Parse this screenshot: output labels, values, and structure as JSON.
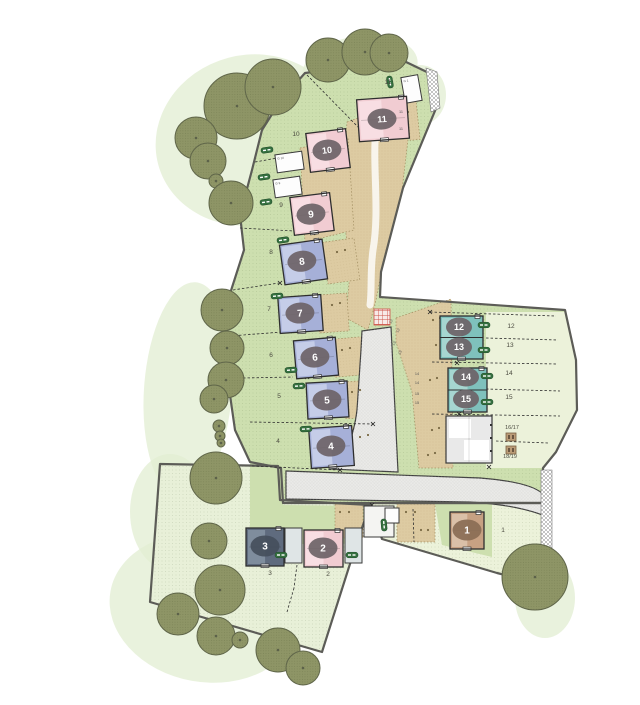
{
  "title": "Housing development site plan",
  "colors": {
    "background": "#ffffff",
    "field_green": "#cddfaf",
    "field_pale": "#e8f0d8",
    "garden_pale": "#ecf2da",
    "blob_green": "#e2edd2",
    "tree_fill": "#8e9566",
    "tree_edge": "#60664a",
    "tan_drive": "#ddcba2",
    "road_fill": "#eaeae8",
    "road_edge": "#3d3d3d",
    "boundary": "#5c5c57",
    "house_outline": "#2e2e2e",
    "badge_fill": "#6d6367",
    "badge_text": "#ffffff",
    "label_text": "#4b4b40",
    "pink": "#f1ccd2",
    "pink_light": "#f8e0e4",
    "lavender": "#a6b0d8",
    "lavender_light": "#c9d0ea",
    "teal": "#7fc1bc",
    "teal_light": "#abd8d3",
    "slate": "#5f6b7e",
    "slate_light": "#8391a1",
    "brown": "#c7a183",
    "brown_light": "#dbc3ac",
    "badge_brown": "#8a6d55",
    "badge_dark": "#454f5c",
    "garage_fill": "#fdfdfd",
    "block_fill": "#e9e9e9",
    "pill_green": "#35703f",
    "red_hatch": "#cc5146",
    "bin_fill": "#bb9c77"
  },
  "plan": {
    "fields": {
      "north": "305,73 404,61 431,74 437,106 403,188 381,272 380,297 565,310 576,360 577,410 556,452 543,468 543,503 283,503 281,468 250,462 235,430 230,395 226,350 228,300 244,250 240,215 252,170 262,130 281,100",
      "southwest": "160,464 278,466 280,500 370,505 356,545 322,652 150,602",
      "southeast": "370,503 543,503 546,550 537,583 497,573 382,539"
    },
    "overlays": [
      {
        "pts": "486,312 565,312 576,360 577,408 556,452 543,468 486,468",
        "fill": "garden_pale"
      },
      {
        "pts": "250,463 281,468 283,505 368,506 357,543 250,545",
        "fill": "field_green"
      },
      {
        "pts": "435,504 492,504 492,557 442,545",
        "fill": "field_green"
      }
    ],
    "blobs": [
      [
        250,
        140,
        95,
        85,
        -15
      ],
      [
        360,
        68,
        58,
        32,
        -8
      ],
      [
        420,
        95,
        26,
        30,
        0
      ],
      [
        188,
        390,
        44,
        108,
        4
      ],
      [
        170,
        512,
        40,
        58,
        0
      ],
      [
        205,
        608,
        96,
        74,
        10
      ],
      [
        545,
        598,
        30,
        40,
        0
      ]
    ],
    "tans": [
      "347,122 413,98 402,190 384,258 376,300 368,330 346,318 350,272 345,225 344,170",
      "300,148 348,138 354,230 305,242",
      "396,318 451,299 453,468 419,468 412,392 396,342"
    ],
    "bays": [
      [
        325,
        240,
        32,
        42,
        -8
      ],
      [
        318,
        294,
        30,
        38,
        -4
      ],
      [
        333,
        338,
        30,
        38,
        -5
      ],
      [
        345,
        381,
        28,
        37,
        -3
      ],
      [
        352,
        426,
        28,
        41,
        -3
      ],
      [
        335,
        504,
        28,
        34,
        0
      ],
      [
        397,
        504,
        38,
        38,
        0
      ],
      [
        408,
        100,
        10,
        40,
        -6
      ]
    ],
    "roads": {
      "main": "M286,471 L480,478 Q543,483 546,500 L545,516 Q518,505 470,502 L286,499 Z",
      "spur": "M362,331 L391,327 L398,472 L330,469 Q352,452 357,410 L361,350 Z"
    },
    "white_path": "M376,128 C372,165 380,210 373,250 C370,272 372,290 370,305",
    "hatches": [
      "541,470 552,470 552,552 541,552",
      "426,68 437,72 440,108 431,112"
    ],
    "red_hatch": {
      "x": 374,
      "y": 309,
      "s": 16
    },
    "houses": [
      {
        "n": "1",
        "c": "brown",
        "x": 450,
        "y": 512,
        "w": 34,
        "h": 37,
        "rot": 0,
        "bx": 467,
        "by": 530,
        "badge": "badge_brown"
      },
      {
        "n": "2",
        "c": "pink",
        "x": 304,
        "y": 530,
        "w": 39,
        "h": 37,
        "rot": 0,
        "bx": 323,
        "by": 548
      },
      {
        "n": "3",
        "c": "slate",
        "x": 246,
        "y": 528,
        "w": 38,
        "h": 38,
        "rot": 0,
        "bx": 265,
        "by": 546,
        "badge": "badge_dark"
      },
      {
        "n": "4",
        "c": "lavender",
        "x": 310,
        "y": 427,
        "w": 43,
        "h": 40,
        "rot": -4,
        "bx": 331,
        "by": 446
      },
      {
        "n": "5",
        "c": "lavender",
        "x": 307,
        "y": 382,
        "w": 41,
        "h": 36,
        "rot": -3,
        "bx": 327,
        "by": 400
      },
      {
        "n": "6",
        "c": "lavender",
        "x": 295,
        "y": 339,
        "w": 42,
        "h": 38,
        "rot": -5,
        "bx": 315,
        "by": 357
      },
      {
        "n": "7",
        "c": "lavender",
        "x": 279,
        "y": 296,
        "w": 43,
        "h": 36,
        "rot": -4,
        "bx": 300,
        "by": 313
      },
      {
        "n": "8",
        "c": "lavender",
        "x": 282,
        "y": 242,
        "w": 43,
        "h": 40,
        "rot": -8,
        "bx": 302,
        "by": 261
      },
      {
        "n": "9",
        "c": "pink",
        "x": 292,
        "y": 195,
        "w": 40,
        "h": 38,
        "rot": -7,
        "bx": 311,
        "by": 214
      },
      {
        "n": "10",
        "c": "pink",
        "x": 308,
        "y": 131,
        "w": 40,
        "h": 39,
        "rot": -7,
        "bx": 327,
        "by": 150
      },
      {
        "n": "11",
        "c": "pink",
        "x": 358,
        "y": 98,
        "w": 50,
        "h": 42,
        "rot": -4,
        "bx": 382,
        "by": 119
      },
      {
        "pair": [
          "12",
          "13"
        ],
        "c": "teal",
        "x": 440,
        "y": 316,
        "w": 43,
        "h": 43,
        "rot": 0,
        "badges": [
          [
            459,
            327
          ],
          [
            459,
            347
          ]
        ]
      },
      {
        "pair": [
          "14",
          "15"
        ],
        "c": "teal",
        "x": 448,
        "y": 368,
        "w": 39,
        "h": 44,
        "rot": 0,
        "badges": [
          [
            466,
            377
          ],
          [
            466,
            399
          ]
        ]
      }
    ],
    "block": {
      "x": 446,
      "y": 416,
      "w": 46,
      "h": 47
    },
    "aux_buildings": [
      {
        "x": 285,
        "y": 528,
        "w": 17,
        "h": 35,
        "fill": "#dfe5e6"
      },
      {
        "x": 345,
        "y": 528,
        "w": 17,
        "h": 35,
        "fill": "#dfe5e6"
      },
      {
        "x": 364,
        "y": 506,
        "w": 30,
        "h": 31,
        "fill": "#f4f4f2"
      },
      {
        "x": 385,
        "y": 508,
        "w": 14,
        "h": 15,
        "fill": "#fdfdfd"
      }
    ],
    "garages": [
      {
        "x": 403,
        "y": 76,
        "w": 17,
        "h": 26,
        "rot": -10,
        "label": "G 1"
      },
      {
        "x": 276,
        "y": 153,
        "w": 27,
        "h": 18,
        "rot": -8,
        "label": "G 10"
      },
      {
        "x": 274,
        "y": 178,
        "w": 27,
        "h": 18,
        "rot": -8,
        "label": "G 9"
      }
    ],
    "bins": [
      [
        506,
        433,
        10,
        8
      ],
      [
        506,
        446,
        10,
        8
      ]
    ],
    "pills": [
      [
        390,
        82,
        80
      ],
      [
        267,
        150,
        -8
      ],
      [
        264,
        177,
        -8
      ],
      [
        266,
        202,
        -8
      ],
      [
        283,
        240,
        -8
      ],
      [
        277,
        296,
        -4
      ],
      [
        291,
        370,
        -4
      ],
      [
        299,
        386,
        -3
      ],
      [
        306,
        429,
        -3
      ],
      [
        484,
        325,
        0
      ],
      [
        484,
        350,
        0
      ],
      [
        487,
        376,
        0
      ],
      [
        487,
        402,
        0
      ],
      [
        281,
        555,
        0
      ],
      [
        352,
        555,
        0
      ],
      [
        384,
        525,
        85
      ]
    ],
    "trees": [
      [
        237,
        106,
        33
      ],
      [
        273,
        87,
        28
      ],
      [
        328,
        60,
        22
      ],
      [
        365,
        52,
        23
      ],
      [
        389,
        53,
        19
      ],
      [
        196,
        138,
        21
      ],
      [
        208,
        161,
        18
      ],
      [
        216,
        181,
        7
      ],
      [
        231,
        203,
        22
      ],
      [
        222,
        310,
        21
      ],
      [
        227,
        348,
        17
      ],
      [
        226,
        380,
        18
      ],
      [
        214,
        399,
        14
      ],
      [
        219,
        426,
        6
      ],
      [
        220,
        436,
        5
      ],
      [
        221,
        443,
        4
      ],
      [
        216,
        478,
        26
      ],
      [
        209,
        541,
        18
      ],
      [
        220,
        590,
        25
      ],
      [
        178,
        614,
        21
      ],
      [
        216,
        636,
        19
      ],
      [
        240,
        640,
        8
      ],
      [
        278,
        650,
        22
      ],
      [
        303,
        668,
        17
      ],
      [
        535,
        577,
        33
      ]
    ],
    "plot_labels": [
      {
        "t": "11",
        "x": 388,
        "y": 84
      },
      {
        "t": "10",
        "x": 296,
        "y": 136
      },
      {
        "t": "9",
        "x": 281,
        "y": 207
      },
      {
        "t": "8",
        "x": 271,
        "y": 254
      },
      {
        "t": "7",
        "x": 269,
        "y": 311
      },
      {
        "t": "6",
        "x": 271,
        "y": 357
      },
      {
        "t": "5",
        "x": 279,
        "y": 398
      },
      {
        "t": "4",
        "x": 278,
        "y": 443
      },
      {
        "t": "3",
        "x": 270,
        "y": 575
      },
      {
        "t": "2",
        "x": 328,
        "y": 576
      },
      {
        "t": "1",
        "x": 503,
        "y": 532
      },
      {
        "t": "12",
        "x": 511,
        "y": 328
      },
      {
        "t": "13",
        "x": 510,
        "y": 347
      },
      {
        "t": "14",
        "x": 509,
        "y": 375
      },
      {
        "t": "15",
        "x": 509,
        "y": 399
      },
      {
        "t": "16/17",
        "x": 512,
        "y": 429
      },
      {
        "t": "18/19",
        "x": 510,
        "y": 458
      }
    ],
    "bay_labels": [
      {
        "t": "11",
        "x": 401,
        "y": 113,
        "r": 0
      },
      {
        "t": "11",
        "x": 401,
        "y": 130,
        "r": 0
      },
      {
        "t": "12",
        "x": 392,
        "y": 322,
        "r": -60
      },
      {
        "t": "12",
        "x": 399,
        "y": 331,
        "r": -60
      },
      {
        "t": "13",
        "x": 395,
        "y": 344,
        "r": -60
      },
      {
        "t": "13",
        "x": 401,
        "y": 353,
        "r": -60
      },
      {
        "t": "14",
        "x": 417,
        "y": 375,
        "r": 0
      },
      {
        "t": "14",
        "x": 417,
        "y": 384,
        "r": 0
      },
      {
        "t": "15",
        "x": 417,
        "y": 395,
        "r": 0
      },
      {
        "t": "15",
        "x": 417,
        "y": 404,
        "r": 0
      }
    ],
    "dashed": [
      [
        307,
        75,
        360,
        129
      ],
      [
        255,
        162,
        300,
        154
      ],
      [
        240,
        228,
        313,
        232
      ],
      [
        233,
        290,
        279,
        283
      ],
      [
        230,
        336,
        295,
        331
      ],
      [
        243,
        378,
        293,
        377
      ],
      [
        250,
        422,
        373,
        424
      ],
      [
        252,
        466,
        340,
        470
      ],
      [
        430,
        312,
        556,
        316
      ],
      [
        486,
        338,
        558,
        340
      ],
      [
        432,
        362,
        558,
        364
      ],
      [
        486,
        389,
        560,
        391
      ],
      [
        432,
        414,
        560,
        416
      ],
      [
        496,
        441,
        548,
        443
      ],
      [
        297,
        565,
        294,
        588
      ],
      [
        294,
        588,
        287,
        612
      ],
      [
        413,
        509,
        414,
        542
      ]
    ],
    "marks_x": [
      [
        313,
        233
      ],
      [
        280,
        283
      ],
      [
        295,
        331
      ],
      [
        307,
        377
      ],
      [
        373,
        424
      ],
      [
        430,
        312
      ],
      [
        457,
        363
      ],
      [
        459,
        414
      ],
      [
        489,
        467
      ],
      [
        372,
        505
      ],
      [
        340,
        470
      ]
    ],
    "dots": [
      [
        337,
        252
      ],
      [
        345,
        250
      ],
      [
        332,
        305
      ],
      [
        340,
        303
      ],
      [
        342,
        350
      ],
      [
        350,
        348
      ],
      [
        352,
        392
      ],
      [
        360,
        390
      ],
      [
        360,
        437
      ],
      [
        368,
        435
      ],
      [
        433,
        320
      ],
      [
        440,
        318
      ],
      [
        436,
        345
      ],
      [
        443,
        343
      ],
      [
        430,
        380
      ],
      [
        437,
        378
      ],
      [
        432,
        430
      ],
      [
        439,
        428
      ],
      [
        428,
        455
      ],
      [
        435,
        453
      ],
      [
        408,
        112
      ],
      [
        408,
        128
      ],
      [
        340,
        512
      ],
      [
        349,
        512
      ],
      [
        406,
        512
      ],
      [
        415,
        512
      ],
      [
        421,
        530
      ],
      [
        428,
        530
      ]
    ]
  }
}
